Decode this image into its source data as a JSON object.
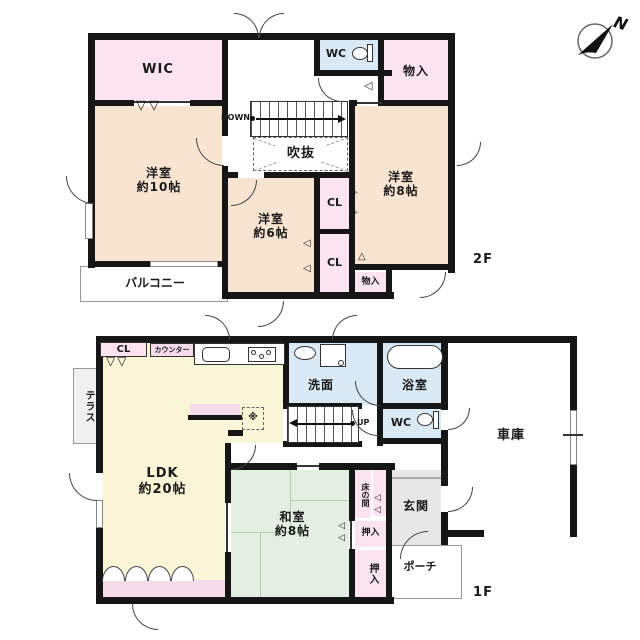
{
  "compass": {
    "north_label": "N"
  },
  "marks": {
    "down_double": "▽▽",
    "right": "▷",
    "left": "◁",
    "up": "△"
  },
  "floor2": {
    "label": "2F",
    "wic": "WIC",
    "wc": "WC",
    "storage_top": "物入",
    "bedroom10_name": "洋室",
    "bedroom10_size": "約10帖",
    "bedroom6_name": "洋室",
    "bedroom6_size": "約6帖",
    "bedroom8_name": "洋室",
    "bedroom8_size": "約8帖",
    "cl_upper": "CL",
    "cl_lower": "CL",
    "storage_bottom": "物入",
    "void": "吹抜",
    "balcony": "バルコニー",
    "stairs_down": "DOWN"
  },
  "floor1": {
    "label": "1F",
    "ldk_name": "LDK",
    "ldk_size": "約20帖",
    "cl": "CL",
    "counter": "カウンター",
    "terrace": "テラス",
    "washroom": "洗面",
    "bath": "浴室",
    "wc": "WC",
    "garage": "車庫",
    "entrance": "玄関",
    "porch": "ポーチ",
    "washitsu_name": "和室",
    "washitsu_size": "約8帖",
    "tokonoma": "床の間",
    "oshiire_upper": "押入",
    "oshiire_lower": "押入",
    "stairs_up": "UP",
    "fridge_mark": "※"
  }
}
